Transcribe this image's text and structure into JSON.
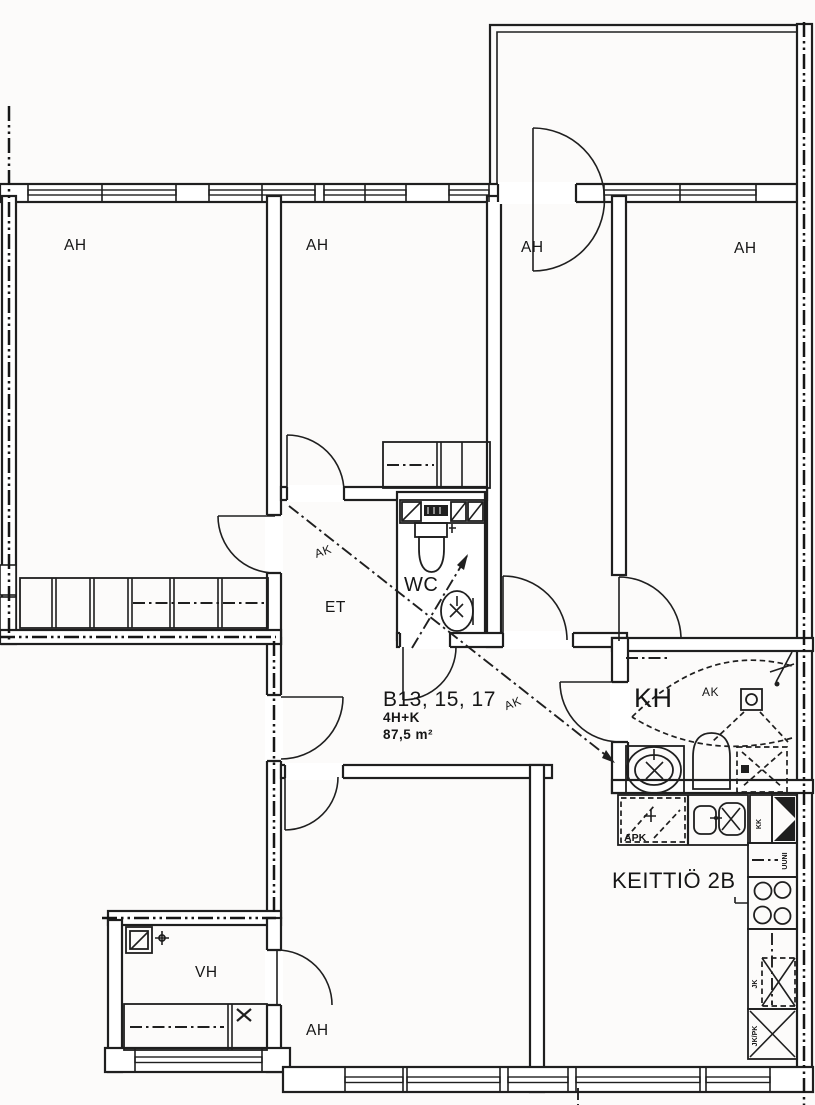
{
  "plan": {
    "apartment": {
      "units": "B13, 15, 17",
      "layout": "4H+K",
      "area": "87,5 m²"
    },
    "rooms": {
      "living_room": "AH",
      "hall": "ET",
      "toilet": "WC",
      "bathroom": "KH",
      "closet_room": "VH",
      "kitchen": "KEITTIÖ 2B"
    },
    "annotations": {
      "ak": "AK",
      "dishwasher": "APK",
      "fridge": "JK",
      "fridge_freezer": "JK/PK",
      "oven": "UUNI",
      "drying_cabinet": "KK"
    }
  }
}
